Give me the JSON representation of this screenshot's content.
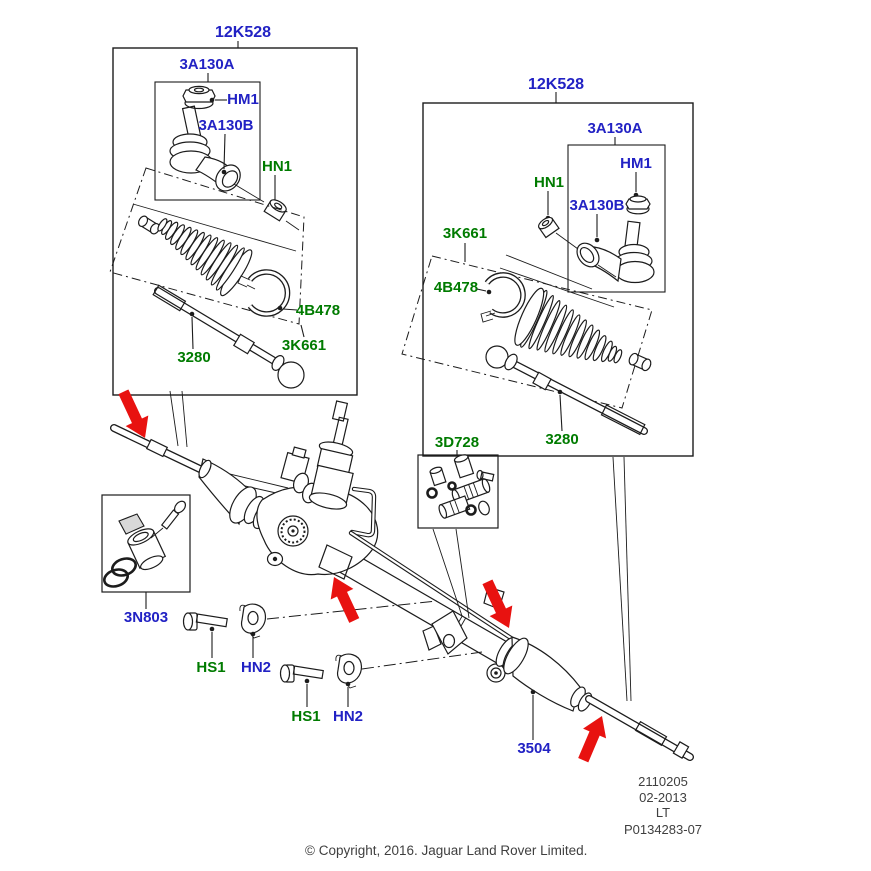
{
  "diagram": {
    "left_box": {
      "code": "12K528",
      "tie_rod_end": "3A130A",
      "nut": "HM1",
      "ball_joint": "3A130B",
      "lock_nut": "HN1",
      "clamp": "4B478",
      "boot_kit": "3K661",
      "inner_rod": "3280"
    },
    "right_box": {
      "code": "12K528",
      "tie_rod_end": "3A130A",
      "nut": "HM1",
      "ball_joint": "3A130B",
      "lock_nut": "HN1",
      "clamp": "4B478",
      "boot_kit": "3K661",
      "inner_rod": "3280"
    },
    "sensor_box": {
      "code": "3N803"
    },
    "fittings_box": {
      "code": "3D728"
    },
    "mounting": {
      "bolt_label": "HS1",
      "clamp_label": "HN2"
    },
    "gear_boot_label": "3504",
    "arrow_color": "#e81210",
    "part_ref_blue": "#2222c4",
    "part_ref_green": "#007b00"
  },
  "doc": {
    "lines": [
      "2110205",
      "02-2013",
      "LT",
      "P0134283-07"
    ]
  },
  "footer": {
    "copyright": "© Copyright, 2016. Jaguar Land Rover Limited."
  }
}
